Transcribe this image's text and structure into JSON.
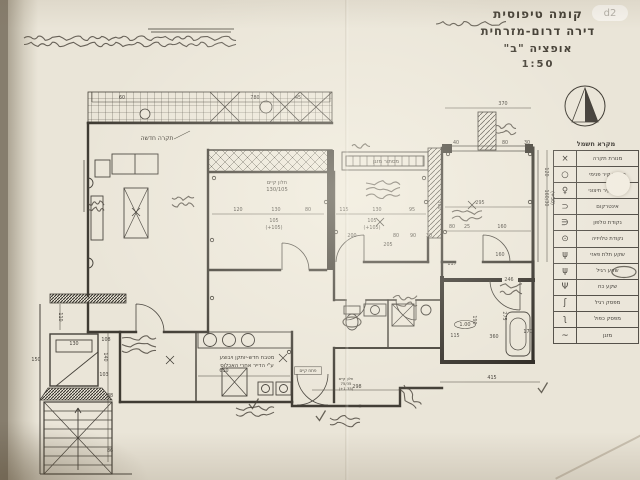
{
  "meta": {
    "document_type": "scanned architectural floor plan",
    "colors": {
      "paper": "#eae5d8",
      "ink": "#3f3b33",
      "pen": "#4a443b",
      "scan_edge": "#867d6d"
    }
  },
  "title_block": {
    "line1": "קומה טיפוסית",
    "line2": "דירה דרום-מזרחית",
    "line3": "אופציה \"ב\"",
    "scale": "1:50"
  },
  "watermark_badge": "d2",
  "legend": {
    "title": "מקרא חשמל",
    "rows": [
      {
        "label": "מנורת תקרה",
        "symbol": "×",
        "symbol_name": "ceiling-light"
      },
      {
        "label": "מנורת קיר פנימי",
        "symbol": "○",
        "symbol_name": "interior-wall-light"
      },
      {
        "label": "מנורת קיר חיצוני",
        "symbol": "♀",
        "symbol_name": "exterior-wall-light"
      },
      {
        "label": "אינטרקום",
        "symbol": "⊂",
        "symbol_name": "intercom"
      },
      {
        "label": "נקודת טלפון",
        "symbol": "∈",
        "symbol_name": "phone-point"
      },
      {
        "label": "נקודת טלויזיה",
        "symbol": "⊙",
        "symbol_name": "tv-point"
      },
      {
        "label": "שקע תלת פאזי",
        "symbol": "ψ",
        "symbol_name": "three-phase-socket"
      },
      {
        "label": "שקע רגיל",
        "symbol": "ψ",
        "symbol_name": "regular-socket"
      },
      {
        "label": "שקע כח",
        "symbol": "Ψ",
        "symbol_name": "power-socket"
      },
      {
        "label": "מפסק רגיל",
        "symbol": "ʃ",
        "symbol_name": "regular-switch"
      },
      {
        "label": "מפסק כפול",
        "symbol": "ʅ",
        "symbol_name": "double-switch"
      },
      {
        "label": "מזגן",
        "symbol": "~",
        "symbol_name": "air-conditioner"
      }
    ]
  },
  "plan": {
    "labels": [
      {
        "text": "תקרה חדשה",
        "x": 157,
        "y": 140,
        "size": 6
      },
      {
        "text": "חלון קיים",
        "x": 277,
        "y": 184,
        "size": 5.2
      },
      {
        "text": "130/105",
        "x": 277,
        "y": 191,
        "size": 5.2
      },
      {
        "text": "מסתור מזגן",
        "x": 386,
        "y": 163,
        "size": 5.4
      },
      {
        "text": "מטבח חדש-יותקן ויבוצע",
        "x": 247,
        "y": 359,
        "size": 5.4
      },
      {
        "text": "ע\"י הדייר אחרי האכלוס",
        "x": 247,
        "y": 367,
        "size": 5.4
      },
      {
        "text": "פתח קיים",
        "x": 308,
        "y": 372,
        "size": 4.2,
        "boxed": true
      },
      {
        "text": "חלון קיים",
        "x": 346,
        "y": 380,
        "size": 3.8
      },
      {
        "text": "75/35",
        "x": 346,
        "y": 385,
        "size": 3.8
      },
      {
        "text": "(+1.35)",
        "x": 346,
        "y": 390,
        "size": 3.8
      },
      {
        "text": "1.00",
        "x": 465,
        "y": 326,
        "size": 5,
        "oval": true
      }
    ],
    "dimensions": [
      {
        "text": "780",
        "x": 255,
        "y": 99
      },
      {
        "text": "60",
        "x": 122,
        "y": 99
      },
      {
        "text": "45",
        "x": 298,
        "y": 99
      },
      {
        "text": "370",
        "x": 503,
        "y": 105
      },
      {
        "text": "40",
        "x": 456,
        "y": 144
      },
      {
        "text": "80",
        "x": 505,
        "y": 144
      },
      {
        "text": "30",
        "x": 527,
        "y": 144
      },
      {
        "text": "120",
        "x": 238,
        "y": 211
      },
      {
        "text": "130",
        "x": 276,
        "y": 211
      },
      {
        "text": "80",
        "x": 308,
        "y": 211
      },
      {
        "text": "105",
        "x": 274,
        "y": 222
      },
      {
        "text": "(+105)",
        "x": 274,
        "y": 229
      },
      {
        "text": "115",
        "x": 344,
        "y": 211
      },
      {
        "text": "130",
        "x": 377,
        "y": 211
      },
      {
        "text": "95",
        "x": 412,
        "y": 211
      },
      {
        "text": "105",
        "x": 372,
        "y": 222
      },
      {
        "text": "(+105)",
        "x": 372,
        "y": 229
      },
      {
        "text": "200",
        "x": 352,
        "y": 237
      },
      {
        "text": "80",
        "x": 396,
        "y": 237
      },
      {
        "text": "90",
        "x": 413,
        "y": 237
      },
      {
        "text": "30",
        "x": 429,
        "y": 237
      },
      {
        "text": "205",
        "x": 388,
        "y": 246
      },
      {
        "text": "295",
        "x": 480,
        "y": 204
      },
      {
        "text": "360",
        "x": 438,
        "y": 205,
        "rot": 90
      },
      {
        "text": "80",
        "x": 452,
        "y": 228
      },
      {
        "text": "25",
        "x": 467,
        "y": 228
      },
      {
        "text": "160",
        "x": 502,
        "y": 228
      },
      {
        "text": "117",
        "x": 452,
        "y": 265
      },
      {
        "text": "160",
        "x": 500,
        "y": 256
      },
      {
        "text": "120",
        "x": 545,
        "y": 172,
        "rot": 90
      },
      {
        "text": "160/30",
        "x": 545,
        "y": 198,
        "rot": 90
      },
      {
        "text": "(+50)",
        "x": 551,
        "y": 198,
        "rot": 90
      },
      {
        "text": "275",
        "x": 503,
        "y": 316,
        "rot": 90
      },
      {
        "text": "190",
        "x": 473,
        "y": 320,
        "rot": 90
      },
      {
        "text": "246",
        "x": 509,
        "y": 281
      },
      {
        "text": "360",
        "x": 494,
        "y": 338
      },
      {
        "text": "115",
        "x": 455,
        "y": 337
      },
      {
        "text": "170",
        "x": 528,
        "y": 333
      },
      {
        "text": "415",
        "x": 492,
        "y": 379
      },
      {
        "text": "298",
        "x": 357,
        "y": 388
      },
      {
        "text": "610",
        "x": 224,
        "y": 372
      },
      {
        "text": "130",
        "x": 74,
        "y": 345
      },
      {
        "text": "108",
        "x": 106,
        "y": 341
      },
      {
        "text": "140",
        "x": 104,
        "y": 357,
        "rot": 90
      },
      {
        "text": "103",
        "x": 104,
        "y": 376
      },
      {
        "text": "88",
        "x": 110,
        "y": 397
      },
      {
        "text": "86",
        "x": 110,
        "y": 452
      },
      {
        "text": "110",
        "x": 59,
        "y": 317,
        "rot": 90
      },
      {
        "text": "150",
        "x": 36,
        "y": 361
      }
    ]
  },
  "annotations": [
    {
      "name": "top-margin-note",
      "type": "scribble",
      "legible": false,
      "x": 24,
      "y": 38,
      "w": 212,
      "lines": 2,
      "seed": 1
    },
    {
      "name": "top-note-underline",
      "type": "dunderline",
      "x": 148,
      "y": 29,
      "w": 86
    },
    {
      "name": "signature-scribble",
      "type": "scribble",
      "legible": false,
      "x": 436,
      "y": 24,
      "w": 70,
      "lines": 1,
      "seed": 2
    },
    {
      "name": "living-room-note",
      "type": "scribble",
      "legible": false,
      "x": 172,
      "y": 198,
      "w": 22,
      "lines": 2,
      "seed": 3
    },
    {
      "name": "west-wall-note",
      "type": "scribble",
      "legible": false,
      "x": 88,
      "y": 203,
      "w": 16,
      "lines": 2,
      "seed": 4
    },
    {
      "name": "parents-room-note",
      "type": "scribble",
      "legible": false,
      "x": 366,
      "y": 183,
      "w": 34,
      "lines": 3,
      "seed": 5
    },
    {
      "name": "parents-top-note",
      "type": "scribble",
      "legible": false,
      "x": 352,
      "y": 146,
      "w": 18,
      "lines": 1,
      "seed": 13
    },
    {
      "name": "right-bedroom-note",
      "type": "scribble",
      "legible": false,
      "x": 452,
      "y": 212,
      "w": 30,
      "lines": 2,
      "seed": 6
    },
    {
      "name": "top-right-note",
      "type": "scribble",
      "legible": false,
      "x": 496,
      "y": 126,
      "w": 20,
      "lines": 2,
      "seed": 14
    },
    {
      "name": "bath-note",
      "type": "scribble",
      "legible": false,
      "x": 393,
      "y": 298,
      "w": 24,
      "lines": 2,
      "seed": 7
    },
    {
      "name": "dining-note",
      "type": "scribble",
      "legible": false,
      "x": 122,
      "y": 338,
      "w": 34,
      "lines": 3,
      "seed": 8
    },
    {
      "name": "entry-note",
      "type": "scribble",
      "legible": false,
      "x": 236,
      "y": 408,
      "w": 38,
      "lines": 2,
      "seed": 9
    },
    {
      "name": "bottom-center-note",
      "type": "scribble",
      "legible": false,
      "x": 330,
      "y": 418,
      "w": 30,
      "lines": 2,
      "seed": 10
    },
    {
      "name": "railing-note",
      "type": "scribble",
      "legible": false,
      "x": 404,
      "y": 385,
      "w": 26,
      "lines": 2,
      "angle": 52,
      "seed": 11
    },
    {
      "name": "security-room-note",
      "type": "scribble",
      "legible": false,
      "x": 500,
      "y": 286,
      "w": 22,
      "lines": 2,
      "seed": 12
    },
    {
      "name": "wc-pen-circle",
      "type": "circle",
      "x": 352,
      "y": 322,
      "w": 18,
      "h": 10
    },
    {
      "name": "legend-pen-circle",
      "type": "circle",
      "x": 624,
      "y": 272,
      "w": 24,
      "h": 11
    },
    {
      "name": "check-mark-1",
      "type": "check",
      "x": 249,
      "y": 404
    },
    {
      "name": "check-mark-2",
      "type": "check",
      "x": 538,
      "y": 388
    },
    {
      "name": "check-mark-3",
      "type": "check",
      "x": 316,
      "y": 416
    }
  ]
}
